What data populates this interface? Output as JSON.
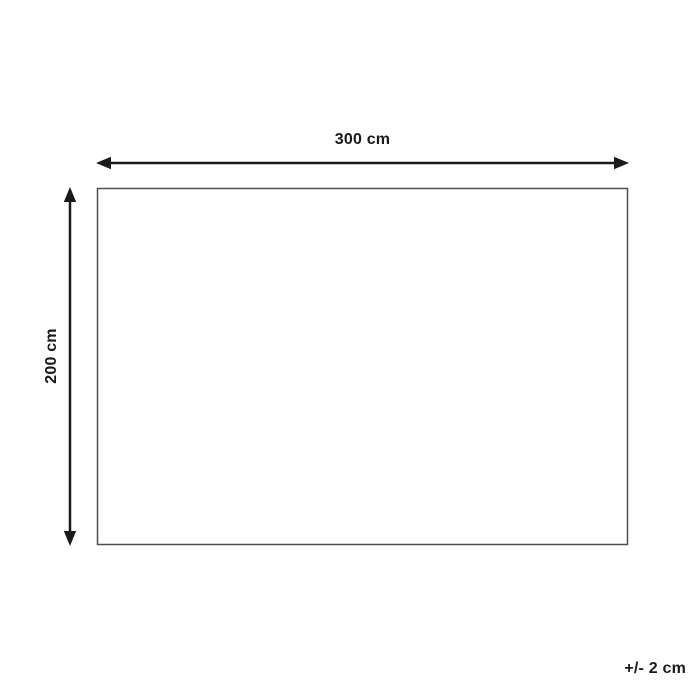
{
  "diagram": {
    "type": "dimension-drawing",
    "width_label": "300 cm",
    "height_label": "200 cm",
    "tolerance_label": "+/- 2 cm",
    "colors": {
      "background": "#ffffff",
      "arrow": "#1a1a1a",
      "rectangle_border": "#4f4f4f",
      "text": "#1a1a1a"
    }
  }
}
